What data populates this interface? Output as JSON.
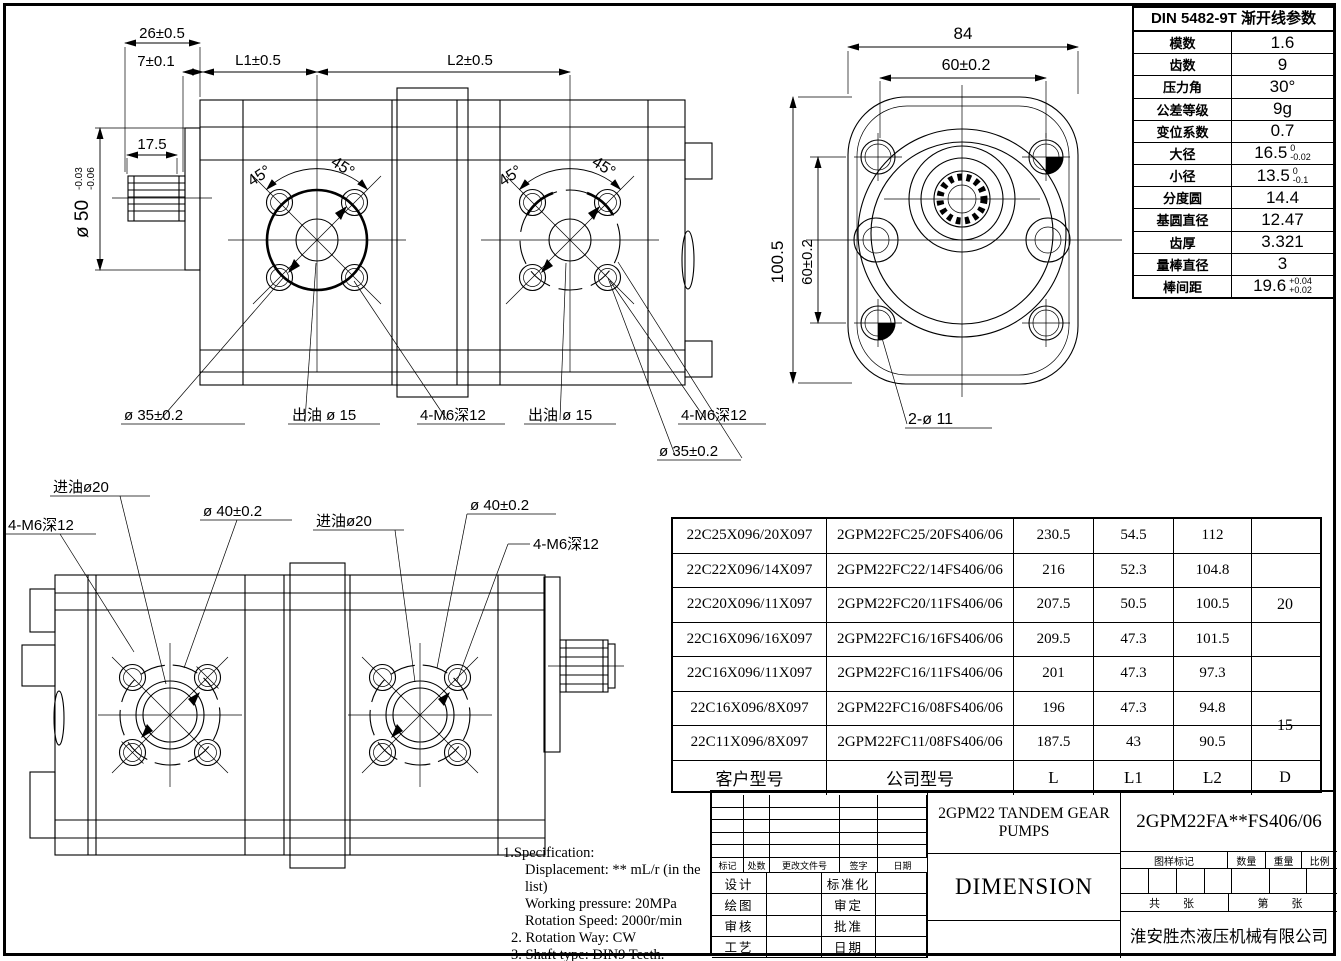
{
  "din_table": {
    "title": "DIN 5482-9T 渐开线参数",
    "rows": [
      {
        "label": "模数",
        "value": "1.6"
      },
      {
        "label": "齿数",
        "value": "9"
      },
      {
        "label": "压力角",
        "value": "30°"
      },
      {
        "label": "公差等级",
        "value": "9g"
      },
      {
        "label": "变位系数",
        "value": "0.7"
      },
      {
        "label": "大径",
        "value": "16.5",
        "tol_top": "0",
        "tol_bot": "-0.02"
      },
      {
        "label": "小径",
        "value": "13.5",
        "tol_top": "0",
        "tol_bot": "-0.1"
      },
      {
        "label": "分度圆",
        "value": "14.4"
      },
      {
        "label": "基圆直径",
        "value": "12.47"
      },
      {
        "label": "齿厚",
        "value": "3.321"
      },
      {
        "label": "量棒直径",
        "value": "3"
      },
      {
        "label": "棒间距",
        "value": "19.6",
        "tol_top": "+0.04",
        "tol_bot": "+0.02"
      }
    ]
  },
  "model_table": {
    "col_headers": {
      "customer": "客户型号",
      "company": "公司型号",
      "l": "L",
      "l1": "L1",
      "l2": "L2",
      "d": "D"
    },
    "rows": [
      {
        "c": "22C25X096/20X097",
        "m": "2GPM22FC25/20FS406/06",
        "l": "230.5",
        "l1": "54.5",
        "l2": "112"
      },
      {
        "c": "22C22X096/14X097",
        "m": "2GPM22FC22/14FS406/06",
        "l": "216",
        "l1": "52.3",
        "l2": "104.8"
      },
      {
        "c": "22C20X096/11X097",
        "m": "2GPM22FC20/11FS406/06",
        "l": "207.5",
        "l1": "50.5",
        "l2": "100.5"
      },
      {
        "c": "22C16X096/16X097",
        "m": "2GPM22FC16/16FS406/06",
        "l": "209.5",
        "l1": "47.3",
        "l2": "101.5"
      },
      {
        "c": "22C16X096/11X097",
        "m": "2GPM22FC16/11FS406/06",
        "l": "201",
        "l1": "47.3",
        "l2": "97.3"
      },
      {
        "c": "22C16X096/8X097",
        "m": "2GPM22FC16/08FS406/06",
        "l": "196",
        "l1": "47.3",
        "l2": "94.8"
      },
      {
        "c": "22C11X096/8X097",
        "m": "2GPM22FC11/08FS406/06",
        "l": "187.5",
        "l1": "43",
        "l2": "90.5"
      }
    ],
    "d_top": "20",
    "d_bottom": "15"
  },
  "top_view": {
    "dim_26": "26±0.5",
    "dim_7": "7±0.1",
    "dim_l1": "L1±0.5",
    "dim_l2": "L2±0.5",
    "dim_175": "17.5",
    "dim_d50": "ø 50",
    "d50_tol_top": "-0.03",
    "d50_tol_bot": "-0.06",
    "angles": [
      "45°",
      "45°",
      "45°",
      "45°"
    ],
    "label_d35_left": "ø 35±0.2",
    "label_outlet_left": "出油 ø 15",
    "label_m6_left": "4-M6深12",
    "label_outlet_right": "出油 ø 15",
    "label_m6_right": "4-M6深12",
    "label_d35_right": "ø 35±0.2"
  },
  "face_view": {
    "dim_84": "84",
    "dim_60h": "60±0.2",
    "dim_1005": "100.5",
    "dim_60v": "60±0.2",
    "label_2d11": "2-ø 11"
  },
  "bottom_view": {
    "label_inlet_left": "进油ø20",
    "label_m6_left": "4-M6深12",
    "label_d40_left": "ø 40±0.2",
    "label_inlet_right": "进油ø20",
    "label_d40_right": "ø 40±0.2",
    "label_m6_right": "4-M6深12"
  },
  "notes": {
    "l1": "1.Specification:",
    "l2": "Displacement: ** mL/r (in the list)",
    "l3": "Working pressure: 20MPa",
    "l4": "Rotation Speed: 2000r/min",
    "l5": "2. Rotation Way: CW",
    "l6": "3. Shaft type: DIN9 Teeth."
  },
  "title_block": {
    "product_title": "2GPM22 TANDEM GEAR PUMPS",
    "drawing_no": "2GPM22FA**FS406/06",
    "sheet_title": "DIMENSION",
    "company": "淮安胜杰液压机械有限公司",
    "rev_headers": [
      "标记",
      "处数",
      "更改文件号",
      "签字",
      "日期"
    ],
    "sign_left": [
      "设计",
      "绘图",
      "审核",
      "工艺"
    ],
    "sign_right": [
      "标准化",
      "审定",
      "批准",
      "日期"
    ],
    "mark_label": "图样标记",
    "qty_label": "数量",
    "weight_label": "重量",
    "scale_label": "比例",
    "sheet_total": "共　张",
    "sheet_index": "第　张"
  }
}
